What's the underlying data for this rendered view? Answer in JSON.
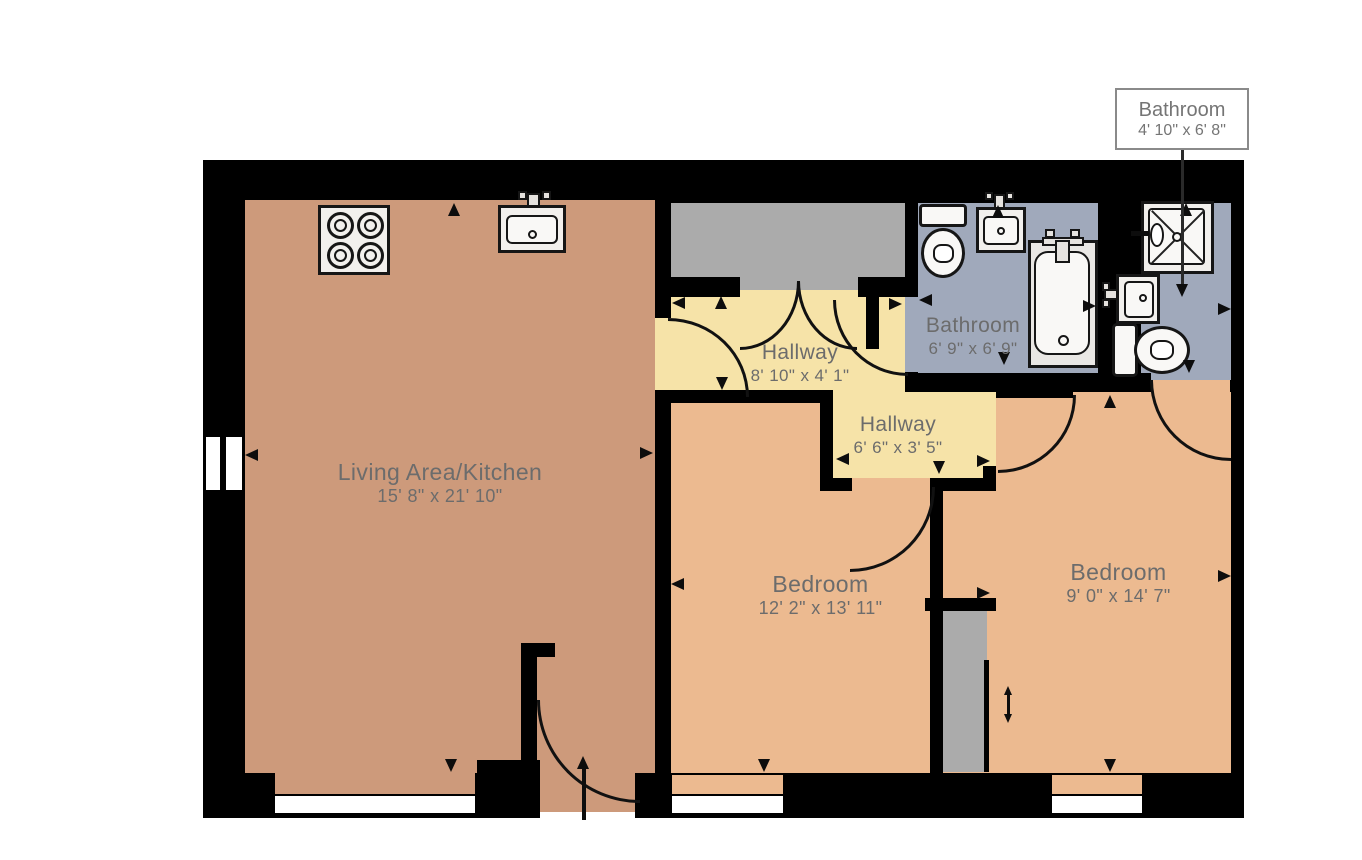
{
  "palette": {
    "wall": "#000000",
    "living": "#CD9A7B",
    "bedroom": "#ECBA90",
    "hall": "#F6E3A8",
    "bath": "#A0A9BB",
    "closet": "#ABABAB",
    "fix": "#F2F0ED",
    "fixin": "#F9F8F6",
    "line": "#161616",
    "text": "#6C6C6C"
  },
  "rooms": {
    "living": {
      "name": "Living Area/Kitchen",
      "dims": "15' 8\" x 21' 10\""
    },
    "hallway1": {
      "name": "Hallway",
      "dims": "8' 10\" x 4' 1\""
    },
    "hallway2": {
      "name": "Hallway",
      "dims": "6' 6\" x 3' 5\""
    },
    "bathroom1": {
      "name": "Bathroom",
      "dims": "6' 9\" x 6' 9\""
    },
    "bedroom1": {
      "name": "Bedroom",
      "dims": "12' 2\" x 13' 11\""
    },
    "bedroom2": {
      "name": "Bedroom",
      "dims": "9' 0\" x 14' 7\""
    }
  },
  "callout": {
    "name": "Bathroom",
    "dims": "4' 10\" x 6' 8\""
  },
  "fixtures": [
    "stove",
    "kitchen-sink",
    "toilet",
    "bathroom-sink",
    "bathtub",
    "shower",
    "bathroom-sink",
    "toilet"
  ],
  "features": [
    "entry-arrow",
    "door-swings",
    "sliding-door-arrow",
    "windows",
    "dimension-arrows"
  ]
}
